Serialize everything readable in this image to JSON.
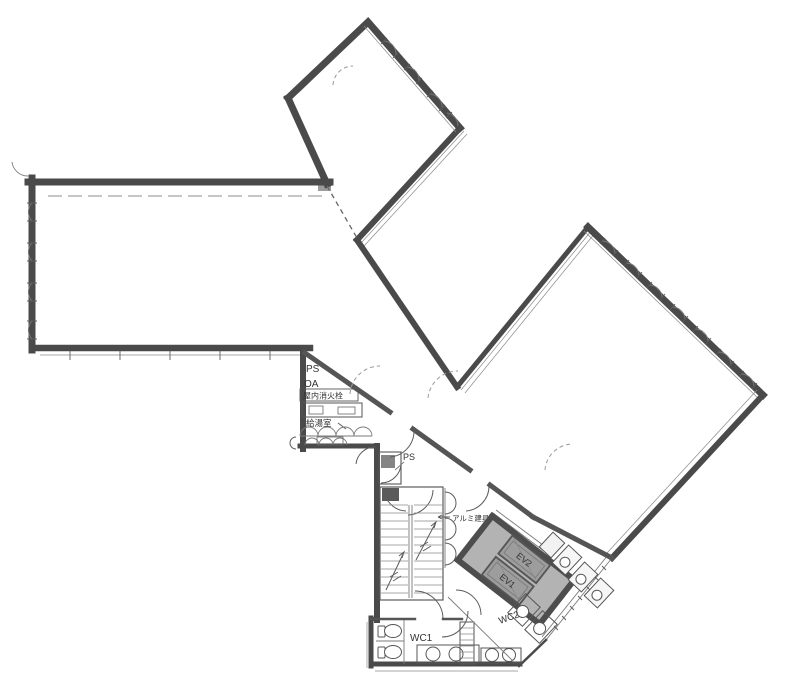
{
  "document": {
    "kind": "scanned floor plan",
    "floor_shape": "three-wing office floor with diagonal elevator core"
  },
  "labels": {
    "ps_upper": "PS",
    "oa": "OA",
    "fire_hydrant": "屋内消火栓",
    "kitchenette": "給湯室",
    "ps_stair": "PS",
    "aluminum_fitting": "アルミ建具",
    "corridor": "廊下",
    "ev2": "EV2",
    "ev1": "EV1",
    "wc2": "WC2",
    "wc1": "WC1"
  },
  "colors": {
    "wall": "#4a4a4a",
    "wall_medium": "#555555",
    "thin_line": "#7a7a7a",
    "elevator_block_fill": "#b3b3b3",
    "elevator_cab_fill": "#9d9d9d",
    "text": "#333333",
    "background": "#ffffff"
  },
  "symbols": {
    "window_icon": "quarter-arc fan on exterior wall",
    "door_icon": "quarter-arc swing",
    "stair_icon": "parallel tread lines with up arrows",
    "toilet_icon": "ellipse bowl with tank rectangle",
    "sink_icon": "circle set in counter",
    "elevator_icon": "shaded tilted cab rectangle"
  }
}
